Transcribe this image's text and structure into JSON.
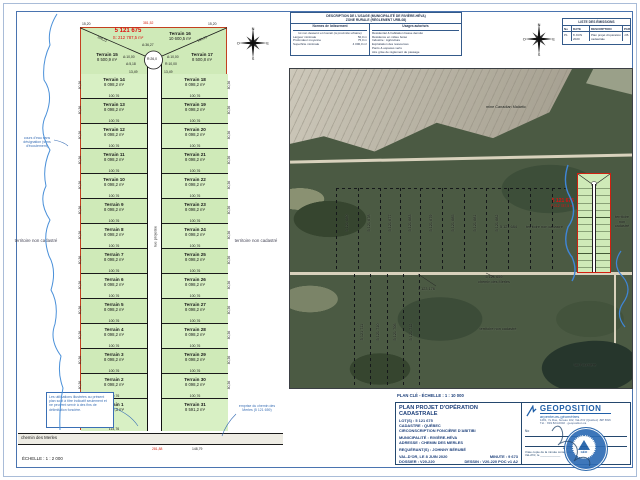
{
  "colors": {
    "lot_green": "#cfeab8",
    "boundary_red": "#c3401f",
    "accent_red": "#e01010",
    "frame_blue": "#4a74b0",
    "navy": "#1c3f7a",
    "geoposition_blue": "#1f5fa8",
    "forest_green": "#4b5a43",
    "mine_gray": "#b4afa0"
  },
  "sheet": {
    "scale_left": "ÉCHELLE : 1 : 2 000",
    "plan_cle": "PLAN CLÉ - ÉCHELLE : 1 : 10 000"
  },
  "left_plan": {
    "main_lot": {
      "number": "5 121 675",
      "area": "S: 212 787,5 m²"
    },
    "territory_left": "territoire non cadastré",
    "territory_right": "territoire non cadastré",
    "stream_note": "cours d'eau sans désignation (sens d'écoulement)",
    "note_box": "Les utilisations illustrées au présent plan sont à titre indicatif seulement et ne peuvent servir à des fins de délimitation foncière.",
    "road_note": "emprise du chemin des Merles (5 121 659)",
    "street_label": "rue projetée",
    "road_label": "chemin des Merles",
    "top": {
      "t15": {
        "name": "Terrain 15",
        "area": "8 500,9 m²"
      },
      "t16": {
        "name": "Terrain 16",
        "area": "10 600,5 m²"
      },
      "t17": {
        "name": "Terrain 17",
        "area": "8 500,8 m²"
      }
    },
    "rows": [
      {
        "l": "Terrain 14",
        "r": "Terrain 18",
        "area": "8 098,2 m²"
      },
      {
        "l": "Terrain 13",
        "r": "Terrain 19",
        "area": "8 098,2 m²"
      },
      {
        "l": "Terrain 12",
        "r": "Terrain 20",
        "area": "8 098,2 m²"
      },
      {
        "l": "Terrain 11",
        "r": "Terrain 21",
        "area": "8 098,2 m²"
      },
      {
        "l": "Terrain 10",
        "r": "Terrain 22",
        "area": "8 098,2 m²"
      },
      {
        "l": "Terrain 9",
        "r": "Terrain 23",
        "area": "8 098,2 m²"
      },
      {
        "l": "Terrain 8",
        "r": "Terrain 24",
        "area": "8 098,2 m²"
      },
      {
        "l": "Terrain 7",
        "r": "Terrain 25",
        "area": "8 098,2 m²"
      },
      {
        "l": "Terrain 6",
        "r": "Terrain 26",
        "area": "8 098,2 m²"
      },
      {
        "l": "Terrain 5",
        "r": "Terrain 27",
        "area": "8 098,2 m²"
      },
      {
        "l": "Terrain 4",
        "r": "Terrain 28",
        "area": "8 098,2 m²"
      },
      {
        "l": "Terrain 3",
        "r": "Terrain 29",
        "area": "8 098,2 m²"
      },
      {
        "l": "Terrain 2",
        "r": "Terrain 30",
        "area": "8 098,2 m²"
      }
    ],
    "bottom": {
      "t1": {
        "name": "Terrain 1",
        "area": "8 009,3 m²",
        "width": "114,76"
      },
      "t31": {
        "name": "Terrain 31",
        "area": "8 591,2 m²",
        "width": "148,79"
      }
    },
    "dims": {
      "width": "100,76",
      "depth": "80,36",
      "top_corner_l": "15,20",
      "top_corner_r": "15,20",
      "top_total": "381,52",
      "diag_l": "109,21",
      "diag_r": "109,21",
      "culdesac_r": "R:26,0",
      "arc_a": "A:36,27",
      "arc_left": "A:10,00",
      "arc_right": "A:10,00",
      "seg_left": "A:5,18",
      "seg_right": "R:10,00",
      "street_w_l": "13,49",
      "street_w_r": "13,49",
      "road_red": "281,88",
      "road_black": "148,79"
    }
  },
  "zoning_table": {
    "title1": "DESCRIPTION DE L'USAGE (MUNICIPALITÉ DE RIVIÈRE-HÉVA)",
    "title2": "ZONE RURALE (RÈGLEMENT URB-08)",
    "col1": {
      "header": "Normes de lotissement",
      "sub": "lot non desservi et riverain (à proximité urbaine)",
      "rows": [
        [
          "Largeur minimale",
          "50,0 m"
        ],
        [
          "Profondeur moyenne",
          "75,0 m"
        ],
        [
          "Superficie minimale",
          "4 000,0 m²"
        ]
      ]
    },
    "col2": {
      "header": "Usages autorisés",
      "rows": [
        "Résidentiel & habitation basse densité",
        "Résidence en milieu boisé",
        "Industrie : Agriculture",
        "Exploitation des ressources",
        "Parcs & espaces verts",
        "Aire grise de règlement de passage"
      ]
    }
  },
  "revision_table": {
    "title": "LISTE DES ÉMISSIONS",
    "headers": [
      "No",
      "DATE",
      "DESCRIPTION",
      "PAR"
    ],
    "rows": [
      [
        "P1",
        "8 JUIN 2020",
        "Plan projet d'opération cadastrale",
        "J.B."
      ]
    ]
  },
  "map": {
    "mine_label": "mine Canadian Malartic",
    "upper_lots": [
      "5 121 680",
      "5 121 678",
      "5 121 677",
      "5 121 683",
      "5 121 679",
      "5 121 685",
      "5 121 681",
      "5 121 682"
    ],
    "lot_684": "5 121 684",
    "territory_mid": "territoire non cadastré",
    "main_lot": "5 121 675",
    "main_lot_area": "S:212 787,5 m²",
    "territory_right": [
      "territoire",
      "non",
      "cadastré"
    ],
    "road_lot": "5 121 659",
    "road_name": "chemin des Merles",
    "lot_176": "5 123 176",
    "lower_lots": [
      "5 121 711",
      "5 121 710",
      "5 121 706",
      "5 121 712"
    ],
    "territory_bottom": "territoire non cadastré",
    "lake": "lac Fournière"
  },
  "title_block": {
    "title": "PLAN PROJET D'OPÉRATION CADASTRALE",
    "lots": "LOT(S) : 5 121 675",
    "cadastre": "CADASTRE : QUÉBEC",
    "circ": "CIRCONSCRIPTION FONCIÈRE D'ABITIBI",
    "muni": "MUNICIPALITÉ : RIVIÈRE-HÉVA",
    "addr": "ADRESSE : CHEMIN DES MERLES",
    "req": "REQUÉRANT(S) : JOHNNY BÉRUBÉ",
    "place_date": "VAL-D'OR, LE 8 JUIN 2020",
    "minute": "MINUTE : 9 673",
    "dossier": "DOSSIER : V20-220",
    "dessin": "DESSIN : V20-220 POC v1 A2",
    "firm": {
      "name": "GEOPOSITION",
      "tagline": "arpenteurs-géomètres",
      "addr1": "1281, 7e Rue, bureau 102, Val-d'Or (Québec) J9P 6W6",
      "addr2": "Tél. : 819 824-0002 · geoposition.ca"
    },
    "no_label": "No",
    "sig_role": "arpenteur-géomètre",
    "copy_note": "Vraie copie de la minute conservée à mon greffe.",
    "copy_place": "Val-d'Or, le",
    "stamp_text": "GÉO"
  },
  "compass": {
    "n": "N",
    "e": "E",
    "s": "S",
    "o": "O"
  }
}
